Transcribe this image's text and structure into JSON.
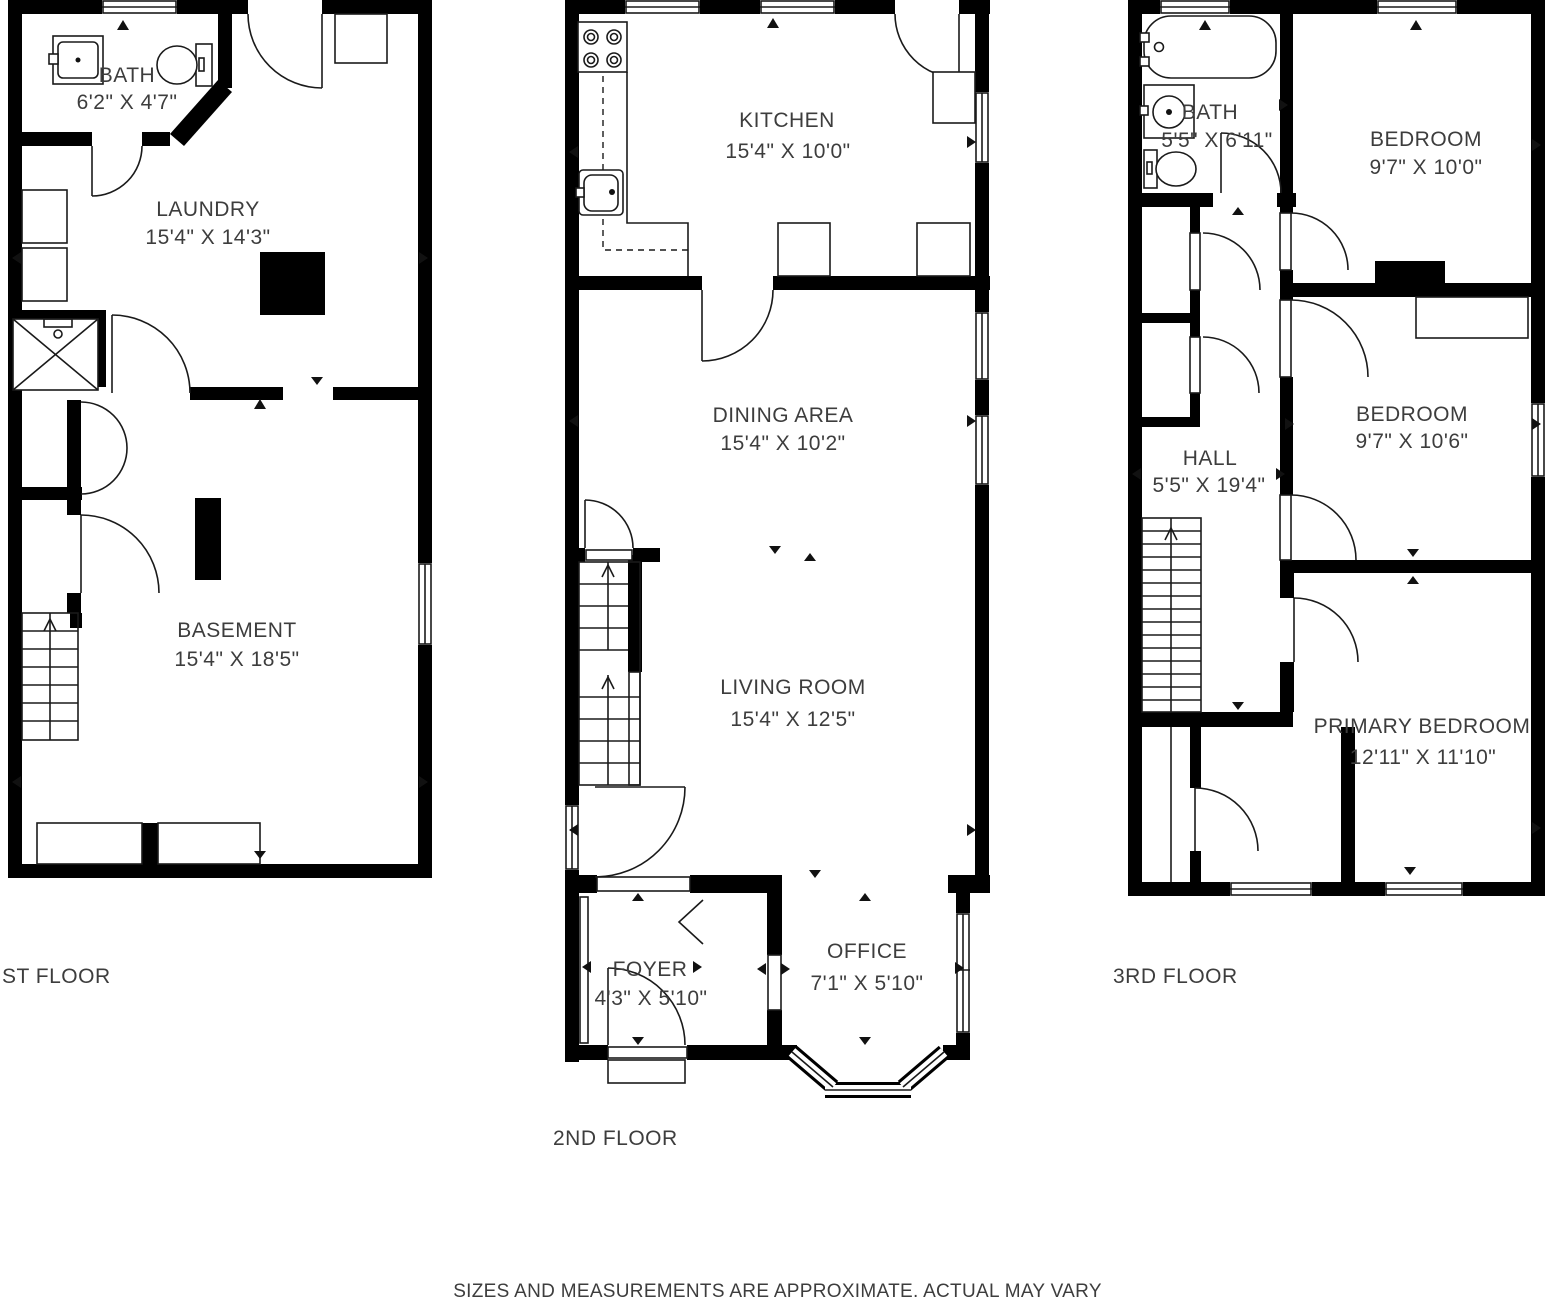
{
  "floors": [
    {
      "label": "ST FLOOR",
      "rooms": [
        {
          "name": "BATH",
          "dims": "6'2\" X 4'7\""
        },
        {
          "name": "LAUNDRY",
          "dims": "15'4\" X 14'3\""
        },
        {
          "name": "BASEMENT",
          "dims": "15'4\" X 18'5\""
        }
      ]
    },
    {
      "label": "2ND FLOOR",
      "rooms": [
        {
          "name": "KITCHEN",
          "dims": "15'4\" X 10'0\""
        },
        {
          "name": "DINING AREA",
          "dims": "15'4\" X 10'2\""
        },
        {
          "name": "LIVING ROOM",
          "dims": "15'4\" X 12'5\""
        },
        {
          "name": "FOYER",
          "dims": "4'3\" X 5'10\""
        },
        {
          "name": "OFFICE",
          "dims": "7'1\" X 5'10\""
        }
      ]
    },
    {
      "label": "3RD FLOOR",
      "rooms": [
        {
          "name": "BATH",
          "dims": "5'5\" X 6'11\""
        },
        {
          "name": "BEDROOM",
          "dims": "9'7\" X 10'0\""
        },
        {
          "name": "HALL",
          "dims": "5'5\" X 19'4\""
        },
        {
          "name": "BEDROOM",
          "dims": "9'7\" X 10'6\""
        },
        {
          "name": "PRIMARY BEDROOM",
          "dims": "12'11\" X 11'10\""
        }
      ]
    }
  ],
  "disclaimer": "SIZES AND MEASUREMENTS ARE APPROXIMATE. ACTUAL MAY VARY"
}
